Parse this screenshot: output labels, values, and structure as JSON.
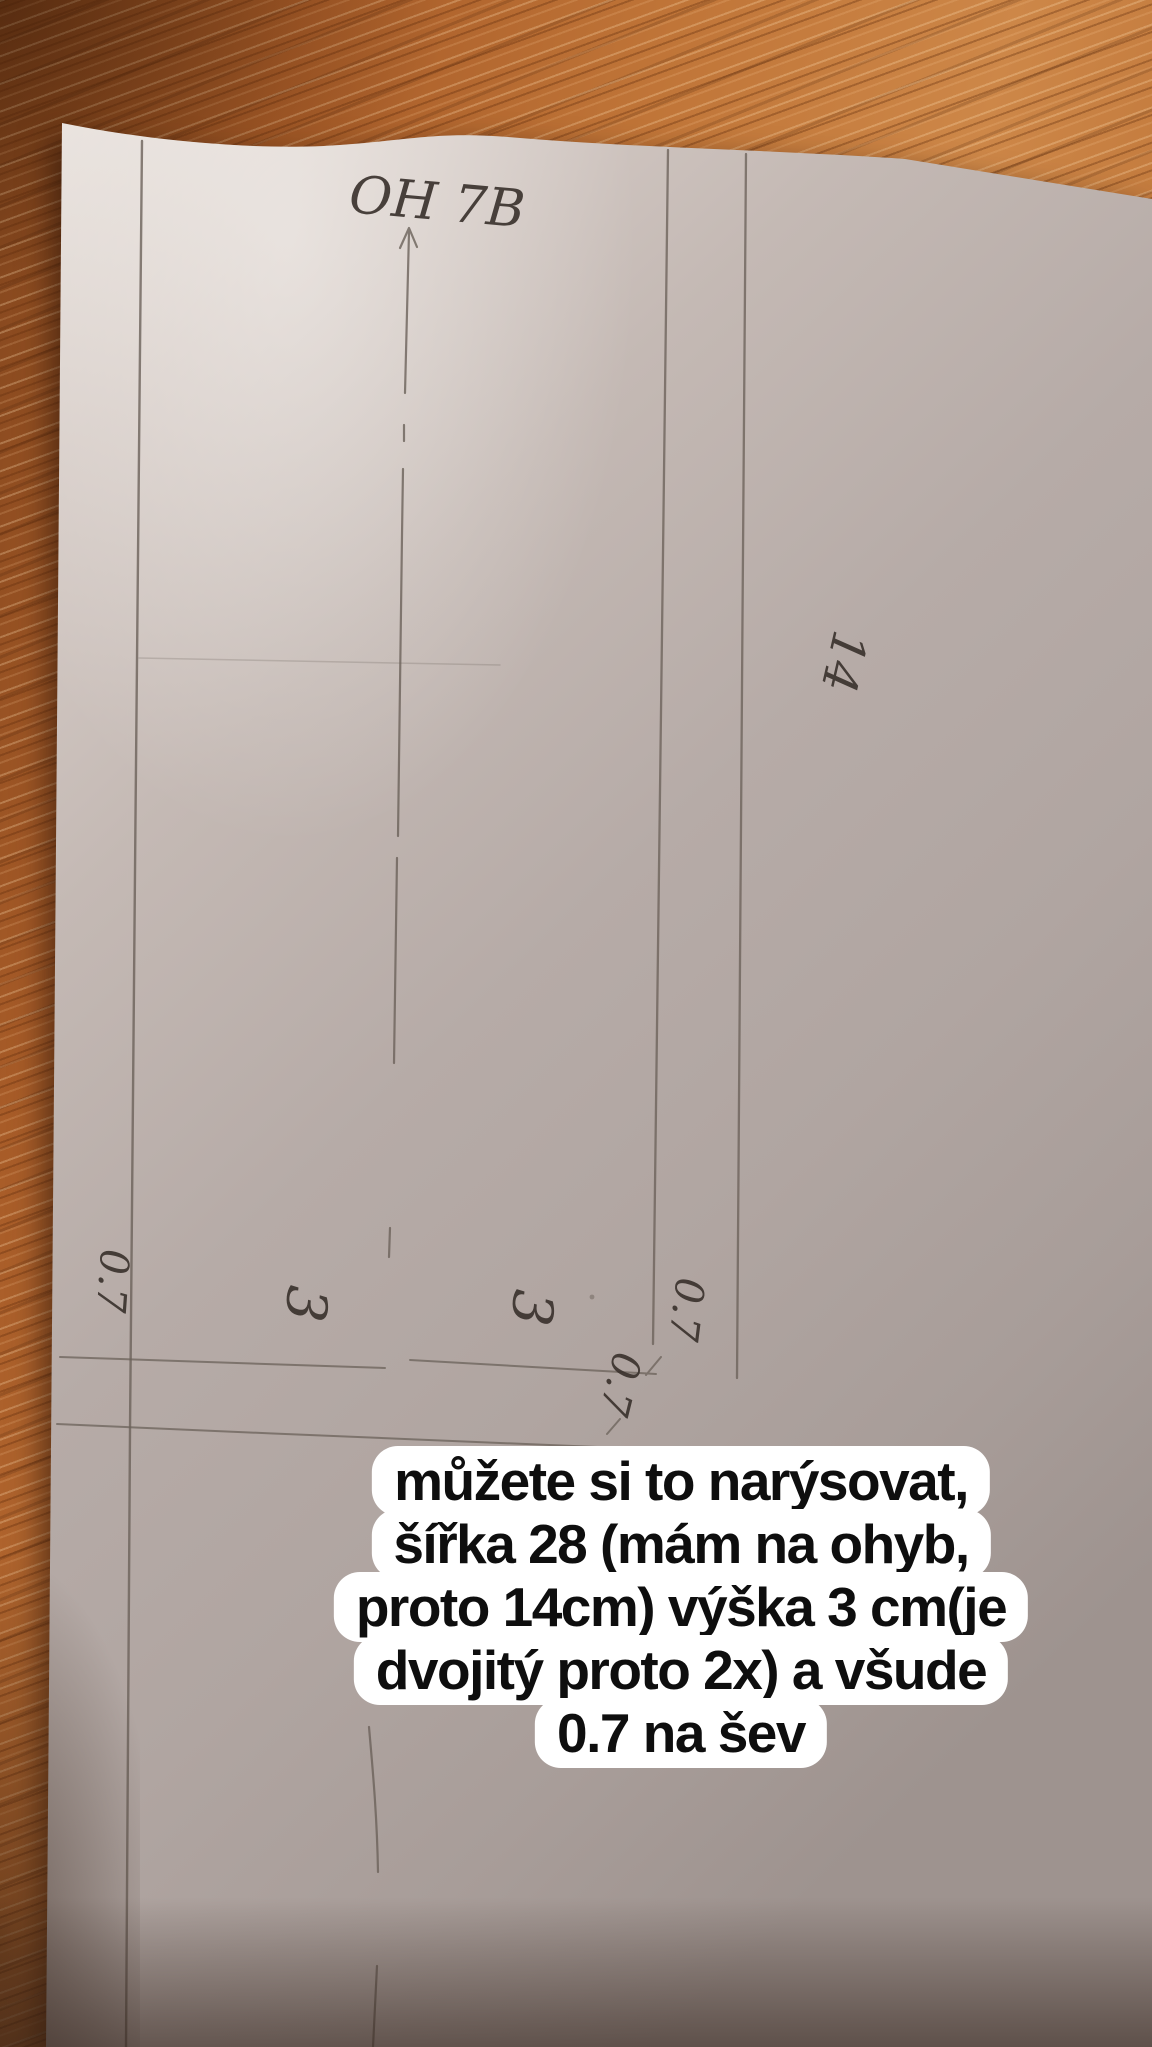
{
  "handwritten_labels": {
    "title": "OH 7B",
    "width_half": "14",
    "height_left": "3",
    "height_mid": "3",
    "seam_left": "0.7",
    "seam_right": "0.7",
    "seam_bottom": "0.7"
  },
  "caption": {
    "lines": [
      "můžete si to narýsovat,",
      "šířka 28 (mám na ohyb,",
      "proto 14cm) výška 3 cm(je",
      "dvojitý proto 2x) a všude",
      "0.7 na šev"
    ],
    "full_text": "můžete si to narýsovat, šířka 28 (mám na ohyb, proto 14cm) výška 3 cm(je dvojitý proto 2x) a všude 0.7 na šev"
  },
  "colors": {
    "wood": "#b4702f",
    "wood_dark": "#7e431c",
    "paper": "#c3b8b2",
    "pencil": "#6b625a",
    "handwriting": "#3b332e",
    "caption_bg": "#ffffff",
    "caption_text": "#0e0e0e"
  }
}
